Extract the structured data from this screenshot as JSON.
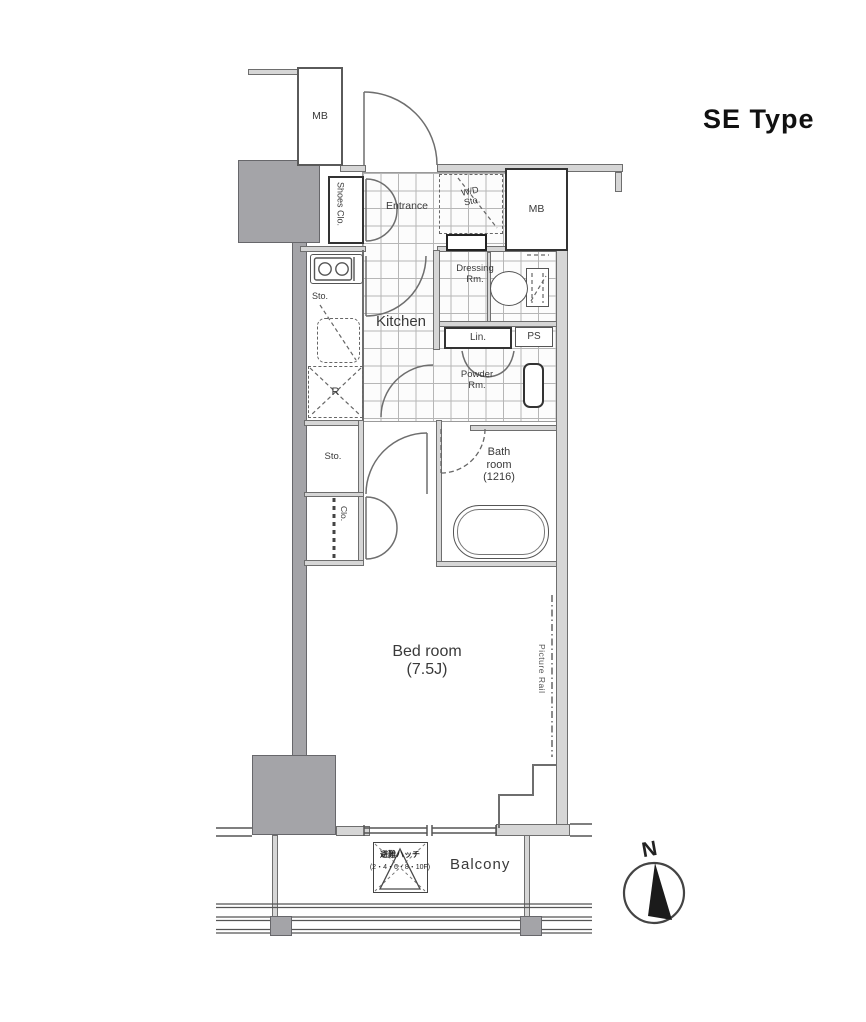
{
  "title": "SE Type",
  "compass": {
    "north": "N"
  },
  "rooms": {
    "entrance": "Entrance",
    "kitchen": "Kitchen",
    "dressing": [
      "Dressing",
      "Rm."
    ],
    "powder": [
      "Powder",
      "Rm."
    ],
    "bath": [
      "Bath",
      "room",
      "(1216)"
    ],
    "bedroom": [
      "Bed room",
      "(7.5J)"
    ],
    "balcony": "Balcony"
  },
  "storage": {
    "shoes_closet": "Shoes Clo.",
    "wd_storage": [
      "W/D",
      "Sto."
    ],
    "kitchen_storage": "Sto.",
    "refrigerator": "R",
    "linen": "Lin.",
    "pipe_space": "PS",
    "storage": "Sto.",
    "closet": "Clo."
  },
  "utility": {
    "meter_box_top": "MB",
    "meter_box_right": "MB",
    "picture_rail": "Picture Rail",
    "hatch": [
      "避難ハッチ",
      "(2・4・6・8・10F)"
    ]
  },
  "colors": {
    "pillar": "#a4a4a8",
    "wall_fill": "#d6d6d6",
    "line": "#6e6e6e",
    "text": "#3a3a3a"
  }
}
